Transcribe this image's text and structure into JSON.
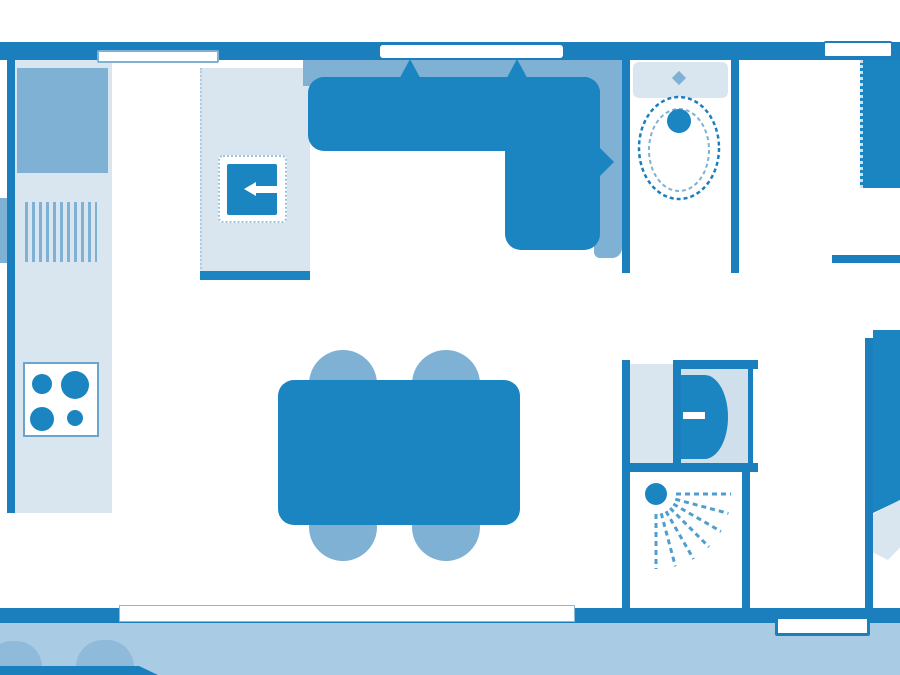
{
  "palette": {
    "wall": "#1a7fbc",
    "furniture_dark": "#1a85c0",
    "furniture_medium": "#7fb1d4",
    "surface_light": "#d9e6f0",
    "basin_light": "#cfe0ec",
    "deck": "#a9cbe4",
    "deck_shrub": "#8fbada",
    "background": "#ffffff"
  },
  "diagram": {
    "kind": "floor-plan",
    "visible_text": "",
    "walls": [
      "top-wall",
      "left-wall",
      "bottom-wall",
      "toilet-room-walls",
      "shower-room-walls",
      "bedroom-partition-wall",
      "hall-wall-stub"
    ],
    "window_count_top": 3,
    "window_count_bottom": 2,
    "furniture_icons": [
      "kitchen-counter-icon",
      "worktop-icon",
      "draining-board-icon",
      "hob-icon",
      "fridge-icon",
      "corner-sofa-icon",
      "dining-table-icon",
      "chair-icon",
      "toilet-icon",
      "washbasin-icon",
      "shower-icon",
      "wardrobe-icon",
      "bed-icon",
      "deck-icon",
      "shrub-icon",
      "path-icon"
    ],
    "hob_burner_count": 4,
    "chair_count": 4,
    "shower_spray_line_count": 7
  }
}
